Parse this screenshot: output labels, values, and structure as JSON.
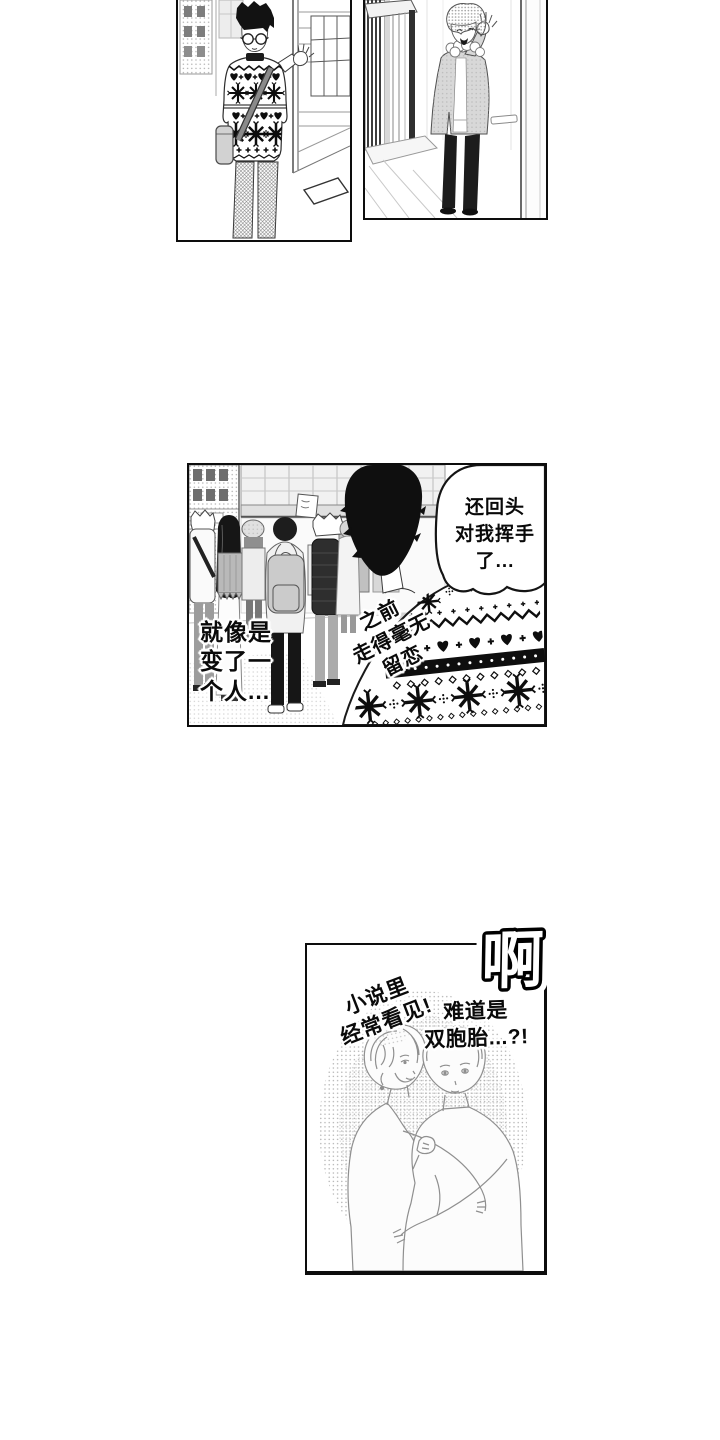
{
  "colors": {
    "ink": "#0d0d0d",
    "paper": "#ffffff",
    "halftone": "#c9c9c9"
  },
  "texts": {
    "bubble_wave": {
      "lines": [
        "还回头",
        "对我挥手",
        "了..."
      ]
    },
    "caption_changed": {
      "lines": [
        "就像是",
        "变了一",
        "个人..."
      ]
    },
    "caption_before": {
      "lines": [
        "之前",
        "走得毫无",
        "留恋"
      ]
    },
    "sfx_ah": "啊",
    "caption_novels": {
      "lines": [
        "小说里",
        "经常看见!"
      ]
    },
    "caption_twins": {
      "lines": [
        "难道是",
        "双胞胎...?!"
      ]
    }
  }
}
